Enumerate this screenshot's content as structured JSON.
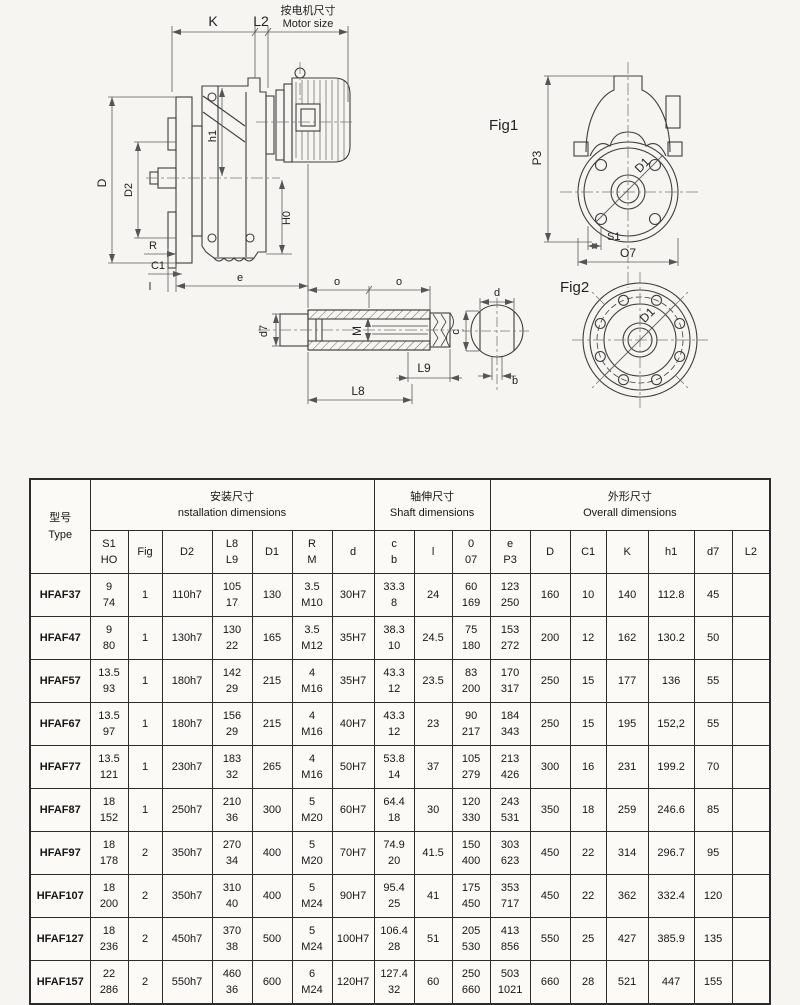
{
  "page": {
    "background": "#f6f5f1",
    "ink": "#2c2c2c"
  },
  "drawing": {
    "labels": {
      "k": "K",
      "l2": "L2",
      "motor_size_cn": "按电机尺寸",
      "motor_size_en": "Motor size",
      "d": "D",
      "d2": "D2",
      "h1": "h1",
      "h0": "H0",
      "r": "R",
      "c1": "C1",
      "l": "l",
      "e": "e",
      "fig1": "Fig1",
      "p3": "P3",
      "d1_fig1": "D1",
      "s1": "S1",
      "o7": "O7",
      "fig2": "Fig2",
      "d1_fig2": "D1",
      "o_left": "o",
      "o_right": "o",
      "m": "M",
      "d7": "d7",
      "l9": "L9",
      "l8": "L8",
      "d_bore": "d",
      "c": "c",
      "b": "b"
    }
  },
  "table": {
    "corner": "型号\nType",
    "groups": [
      {
        "label": "安装尺寸\nnstallation dimensions",
        "span": 7
      },
      {
        "label": "轴伸尺寸\nShaft dimensions",
        "span": 3
      },
      {
        "label": "外形尺寸\nOverall dimensions",
        "span": 7
      }
    ],
    "sub_headers": [
      "S1\nHO",
      "Fig",
      "D2",
      "L8\nL9",
      "D1",
      "R\nM",
      "d",
      "c\nb",
      "l",
      "0\n07",
      "e\nP3",
      "D",
      "C1",
      "K",
      "h1",
      "d7",
      "L2"
    ],
    "rows": [
      {
        "type": "HFAF37",
        "cells": [
          "9\n74",
          "1",
          "110h7",
          "105\n17",
          "130",
          "3.5\nM10",
          "30H7",
          "33.3\n8",
          "24",
          "60\n169",
          "123\n250",
          "160",
          "10",
          "140",
          "112.8",
          "45",
          ""
        ]
      },
      {
        "type": "HFAF47",
        "cells": [
          "9\n80",
          "1",
          "130h7",
          "130\n22",
          "165",
          "3.5\nM12",
          "35H7",
          "38.3\n10",
          "24.5",
          "75\n180",
          "153\n272",
          "200",
          "12",
          "162",
          "130.2",
          "50",
          ""
        ]
      },
      {
        "type": "HFAF57",
        "cells": [
          "13.5\n93",
          "1",
          "180h7",
          "142\n29",
          "215",
          "4\nM16",
          "35H7",
          "43.3\n12",
          "23.5",
          "83\n200",
          "170\n317",
          "250",
          "15",
          "177",
          "136",
          "55",
          ""
        ]
      },
      {
        "type": "HFAF67",
        "cells": [
          "13.5\n97",
          "1",
          "180h7",
          "156\n29",
          "215",
          "4\nM16",
          "40H7",
          "43.3\n12",
          "23",
          "90\n217",
          "184\n343",
          "250",
          "15",
          "195",
          "152,2",
          "55",
          ""
        ]
      },
      {
        "type": "HFAF77",
        "cells": [
          "13.5\n121",
          "1",
          "230h7",
          "183\n32",
          "265",
          "4\nM16",
          "50H7",
          "53.8\n14",
          "37",
          "105\n279",
          "213\n426",
          "300",
          "16",
          "231",
          "199.2",
          "70",
          ""
        ]
      },
      {
        "type": "HFAF87",
        "cells": [
          "18\n152",
          "1",
          "250h7",
          "210\n36",
          "300",
          "5\nM20",
          "60H7",
          "64.4\n18",
          "30",
          "120\n330",
          "243\n531",
          "350",
          "18",
          "259",
          "246.6",
          "85",
          ""
        ]
      },
      {
        "type": "HFAF97",
        "cells": [
          "18\n178",
          "2",
          "350h7",
          "270\n34",
          "400",
          "5\nM20",
          "70H7",
          "74.9\n20",
          "41.5",
          "150\n400",
          "303\n623",
          "450",
          "22",
          "314",
          "296.7",
          "95",
          ""
        ]
      },
      {
        "type": "HFAF107",
        "cells": [
          "18\n200",
          "2",
          "350h7",
          "310\n40",
          "400",
          "5\nM24",
          "90H7",
          "95.4\n25",
          "41",
          "175\n450",
          "353\n717",
          "450",
          "22",
          "362",
          "332.4",
          "120",
          ""
        ]
      },
      {
        "type": "HFAF127",
        "cells": [
          "18\n236",
          "2",
          "450h7",
          "370\n38",
          "500",
          "5\nM24",
          "100H7",
          "106.4\n28",
          "51",
          "205\n530",
          "413\n856",
          "550",
          "25",
          "427",
          "385.9",
          "135",
          ""
        ]
      },
      {
        "type": "HFAF157",
        "cells": [
          "22\n286",
          "2",
          "550h7",
          "460\n36",
          "600",
          "6\nM24",
          "120H7",
          "127.4\n32",
          "60",
          "250\n660",
          "503\n1021",
          "660",
          "28",
          "521",
          "447",
          "155",
          ""
        ]
      }
    ]
  }
}
